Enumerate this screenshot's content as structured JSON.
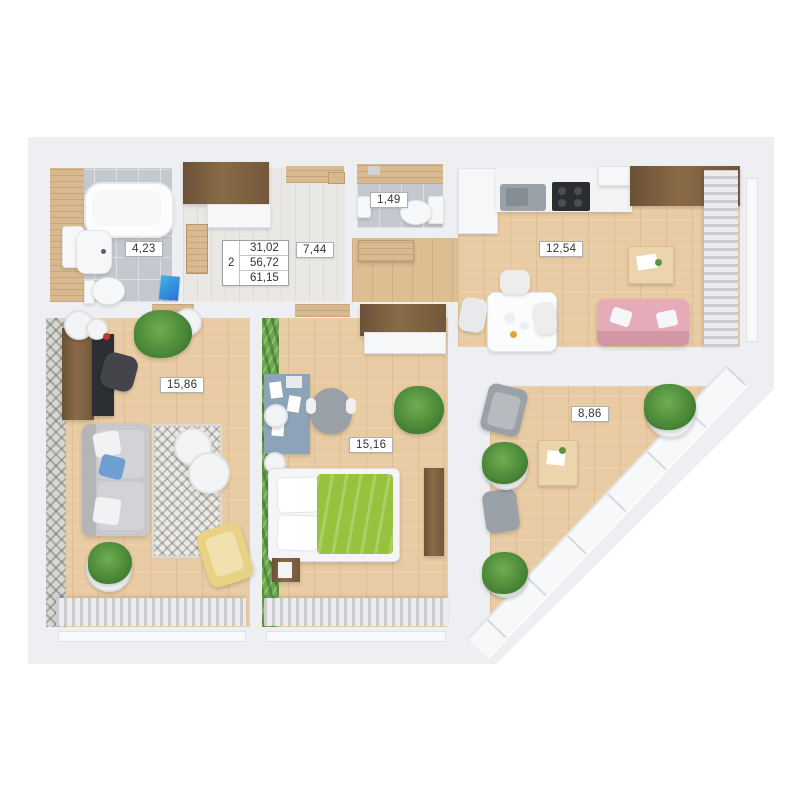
{
  "legend": {
    "room_count": "2",
    "living_area": "31,02",
    "floor_area": "56,72",
    "total_area": "61,15"
  },
  "labels": {
    "bathroom": "4,23",
    "wc": "1,49",
    "hallway": "7,44",
    "kitchen_living": "12,54",
    "living_room": "15,86",
    "bedroom": "15,16",
    "balcony": "8,86"
  },
  "colors": {
    "slab": "#edeff2",
    "wood_floor": "#e8cba2",
    "wood_dark": "#74573a",
    "hall_floor": "#e9e8e5",
    "tile": "#c4c9d0",
    "green_wall": "#6da74e",
    "blanket_green": "#96c23d",
    "sofa_pink": "#e5abb9",
    "sofa_gray": "#c9c9cd",
    "pillow_blue": "#6f9fd2",
    "chair_yellow": "#e9d284",
    "desk_blue": "#8ca3b8",
    "curtain_light": "#ececee",
    "curtain_dark": "#c9cacd",
    "plant_dark": "#3e7a2e",
    "plant_light": "#6fae52"
  }
}
